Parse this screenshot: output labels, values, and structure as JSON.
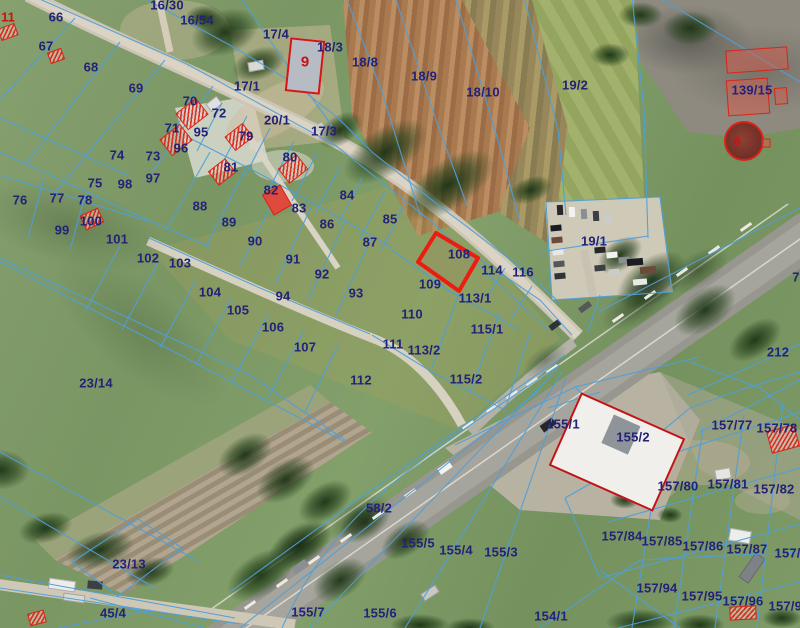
{
  "map": {
    "type": "aerial-cadastral",
    "selected_parcel": "108",
    "colors": {
      "parcel_line": "#4f9fd8",
      "parcel_label": "#232277",
      "highlight": "#ec1c10",
      "red_label": "#cc1111"
    },
    "parcel_labels": [
      {
        "t": "16/30",
        "x": 167,
        "y": 5
      },
      {
        "t": "16/54",
        "x": 197,
        "y": 20
      },
      {
        "t": "66",
        "x": 56,
        "y": 17
      },
      {
        "t": "67",
        "x": 46,
        "y": 46
      },
      {
        "t": "68",
        "x": 91,
        "y": 67
      },
      {
        "t": "69",
        "x": 136,
        "y": 88
      },
      {
        "t": "17/4",
        "x": 276,
        "y": 34
      },
      {
        "t": "18/3",
        "x": 330,
        "y": 47
      },
      {
        "t": "18/8",
        "x": 365,
        "y": 62
      },
      {
        "t": "18/9",
        "x": 424,
        "y": 76
      },
      {
        "t": "18/10",
        "x": 483,
        "y": 92
      },
      {
        "t": "19/2",
        "x": 575,
        "y": 85
      },
      {
        "t": "139/15",
        "x": 752,
        "y": 90
      },
      {
        "t": "17/1",
        "x": 247,
        "y": 86
      },
      {
        "t": "70",
        "x": 190,
        "y": 101
      },
      {
        "t": "72",
        "x": 219,
        "y": 113
      },
      {
        "t": "20/1",
        "x": 277,
        "y": 120
      },
      {
        "t": "17/3",
        "x": 324,
        "y": 131
      },
      {
        "t": "71",
        "x": 172,
        "y": 128
      },
      {
        "t": "95",
        "x": 201,
        "y": 132
      },
      {
        "t": "79",
        "x": 246,
        "y": 136
      },
      {
        "t": "96",
        "x": 181,
        "y": 148
      },
      {
        "t": "74",
        "x": 117,
        "y": 155
      },
      {
        "t": "73",
        "x": 153,
        "y": 156
      },
      {
        "t": "80",
        "x": 290,
        "y": 157
      },
      {
        "t": "81",
        "x": 231,
        "y": 167
      },
      {
        "t": "97",
        "x": 153,
        "y": 178
      },
      {
        "t": "75",
        "x": 95,
        "y": 183
      },
      {
        "t": "98",
        "x": 125,
        "y": 184
      },
      {
        "t": "82",
        "x": 271,
        "y": 190
      },
      {
        "t": "84",
        "x": 347,
        "y": 195
      },
      {
        "t": "76",
        "x": 20,
        "y": 200
      },
      {
        "t": "77",
        "x": 57,
        "y": 198
      },
      {
        "t": "78",
        "x": 85,
        "y": 200
      },
      {
        "t": "88",
        "x": 200,
        "y": 206
      },
      {
        "t": "83",
        "x": 299,
        "y": 208
      },
      {
        "t": "85",
        "x": 390,
        "y": 219
      },
      {
        "t": "86",
        "x": 327,
        "y": 224
      },
      {
        "t": "89",
        "x": 229,
        "y": 222
      },
      {
        "t": "100",
        "x": 91,
        "y": 221
      },
      {
        "t": "99",
        "x": 62,
        "y": 230
      },
      {
        "t": "87",
        "x": 370,
        "y": 242
      },
      {
        "t": "101",
        "x": 117,
        "y": 239
      },
      {
        "t": "90",
        "x": 255,
        "y": 241
      },
      {
        "t": "19/1",
        "x": 594,
        "y": 241
      },
      {
        "t": "108",
        "x": 459,
        "y": 254
      },
      {
        "t": "102",
        "x": 148,
        "y": 258
      },
      {
        "t": "103",
        "x": 180,
        "y": 263
      },
      {
        "t": "91",
        "x": 293,
        "y": 259
      },
      {
        "t": "114",
        "x": 492,
        "y": 270
      },
      {
        "t": "116",
        "x": 523,
        "y": 272
      },
      {
        "t": "92",
        "x": 322,
        "y": 274
      },
      {
        "t": "109",
        "x": 430,
        "y": 284
      },
      {
        "t": "104",
        "x": 210,
        "y": 292
      },
      {
        "t": "93",
        "x": 356,
        "y": 293
      },
      {
        "t": "94",
        "x": 283,
        "y": 296
      },
      {
        "t": "113/1",
        "x": 475,
        "y": 298
      },
      {
        "t": "105",
        "x": 238,
        "y": 310
      },
      {
        "t": "110",
        "x": 412,
        "y": 314
      },
      {
        "t": "115/1",
        "x": 487,
        "y": 329
      },
      {
        "t": "106",
        "x": 273,
        "y": 327
      },
      {
        "t": "111",
        "x": 393,
        "y": 344
      },
      {
        "t": "113/2",
        "x": 424,
        "y": 350
      },
      {
        "t": "107",
        "x": 305,
        "y": 347
      },
      {
        "t": "112",
        "x": 361,
        "y": 380
      },
      {
        "t": "115/2",
        "x": 466,
        "y": 379
      },
      {
        "t": "212",
        "x": 778,
        "y": 352
      },
      {
        "t": "7",
        "x": 796,
        "y": 277
      },
      {
        "t": "23/14",
        "x": 96,
        "y": 383
      },
      {
        "t": "155/1",
        "x": 563,
        "y": 424
      },
      {
        "t": "157/77",
        "x": 732,
        "y": 425
      },
      {
        "t": "157/78",
        "x": 777,
        "y": 428
      },
      {
        "t": "155/2",
        "x": 633,
        "y": 437
      },
      {
        "t": "157/80",
        "x": 678,
        "y": 486
      },
      {
        "t": "157/81",
        "x": 728,
        "y": 484
      },
      {
        "t": "157/82",
        "x": 774,
        "y": 489
      },
      {
        "t": "58/2",
        "x": 379,
        "y": 508
      },
      {
        "t": "157/84",
        "x": 622,
        "y": 536
      },
      {
        "t": "157/85",
        "x": 662,
        "y": 541
      },
      {
        "t": "157/86",
        "x": 703,
        "y": 546
      },
      {
        "t": "157/87",
        "x": 747,
        "y": 549
      },
      {
        "t": "157/88",
        "x": 795,
        "y": 553
      },
      {
        "t": "23/13",
        "x": 129,
        "y": 564
      },
      {
        "t": "155/5",
        "x": 418,
        "y": 543
      },
      {
        "t": "155/4",
        "x": 456,
        "y": 550
      },
      {
        "t": "155/3",
        "x": 501,
        "y": 552
      },
      {
        "t": "157/94",
        "x": 657,
        "y": 588
      },
      {
        "t": "157/95",
        "x": 702,
        "y": 596
      },
      {
        "t": "157/96",
        "x": 743,
        "y": 601
      },
      {
        "t": "157/97",
        "x": 789,
        "y": 606
      },
      {
        "t": "45/4",
        "x": 113,
        "y": 613
      },
      {
        "t": "155/7",
        "x": 308,
        "y": 612
      },
      {
        "t": "155/6",
        "x": 380,
        "y": 613
      },
      {
        "t": "154/1",
        "x": 551,
        "y": 616
      }
    ],
    "red_labels": [
      {
        "t": "9",
        "x": 305,
        "y": 62,
        "size": 15
      },
      {
        "t": "11",
        "x": 8,
        "y": 17,
        "size": 13
      },
      {
        "t": "8",
        "x": 737,
        "y": 142,
        "size": 11
      }
    ]
  }
}
